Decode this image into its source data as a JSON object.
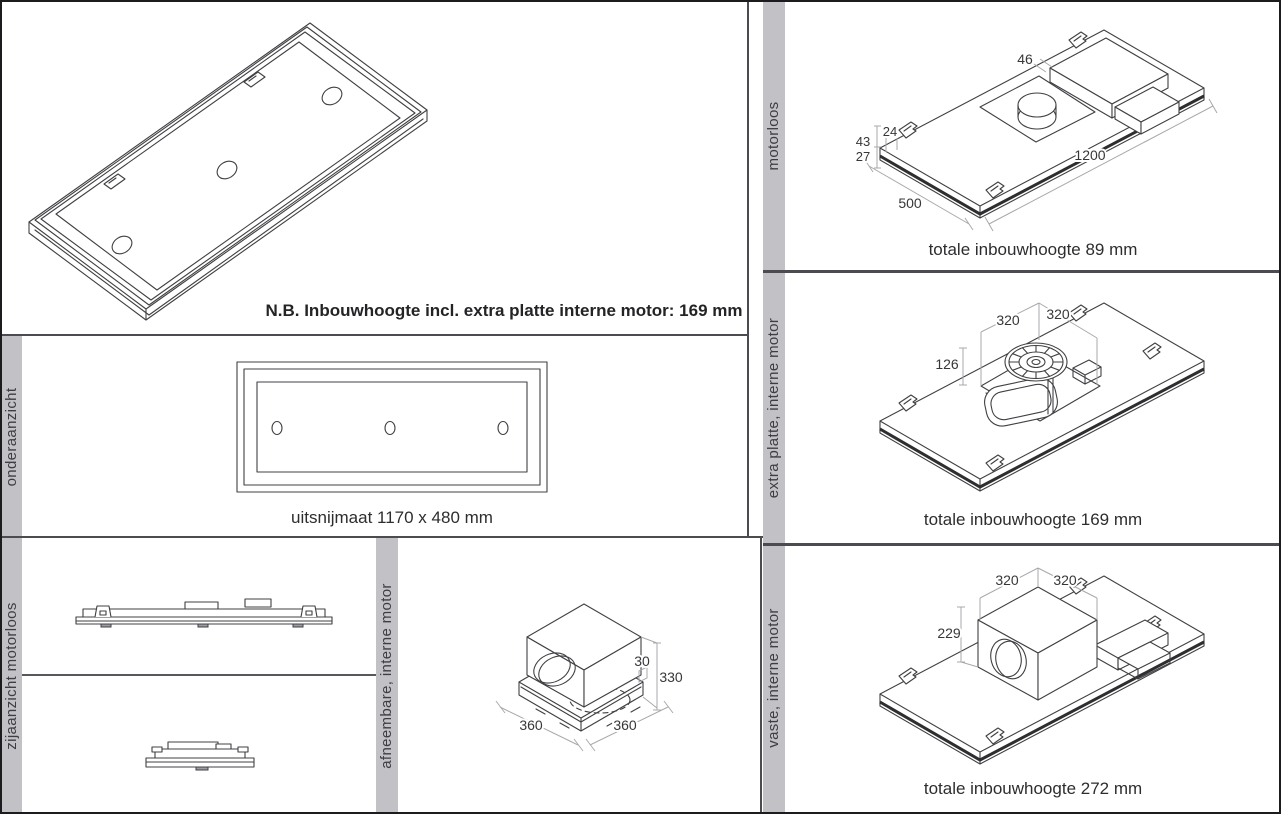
{
  "note": "N.B. Inbouwhoogte incl. extra platte interne motor: 169 mm",
  "panels": {
    "onderaanzicht": {
      "label": "onderaanzicht",
      "caption": "uitsnijmaat 1170 x 480 mm"
    },
    "zijaanzicht": {
      "label": "zijaanzicht motorloos"
    },
    "afneembare": {
      "label": "afneembare, interne motor",
      "dims": {
        "plate_h": "30",
        "total_h": "330",
        "width": "360",
        "depth": "360"
      }
    },
    "motorloos": {
      "label": "motorloos",
      "caption": "totale inbouwhoogte 89 mm",
      "dims": {
        "duct_w": "46",
        "tab_w": "24",
        "edge_total": "43",
        "edge_lower": "27",
        "length": "1200",
        "depth": "500"
      }
    },
    "extra_platte": {
      "label": "extra platte, interne motor",
      "caption": "totale inbouwhoogte 169 mm",
      "dims": {
        "unit_w": "320",
        "unit_d": "320",
        "unit_h": "126"
      }
    },
    "vaste": {
      "label": "vaste, interne motor",
      "caption": "totale inbouwhoogte 272 mm",
      "dims": {
        "unit_w": "320",
        "unit_d": "320",
        "unit_h": "229"
      }
    }
  },
  "colors": {
    "strip": "#c2c2c6",
    "divider": "#4c4c50",
    "line": "#404044",
    "dim_line": "#a9a9ad",
    "text": "#2d2d30"
  }
}
